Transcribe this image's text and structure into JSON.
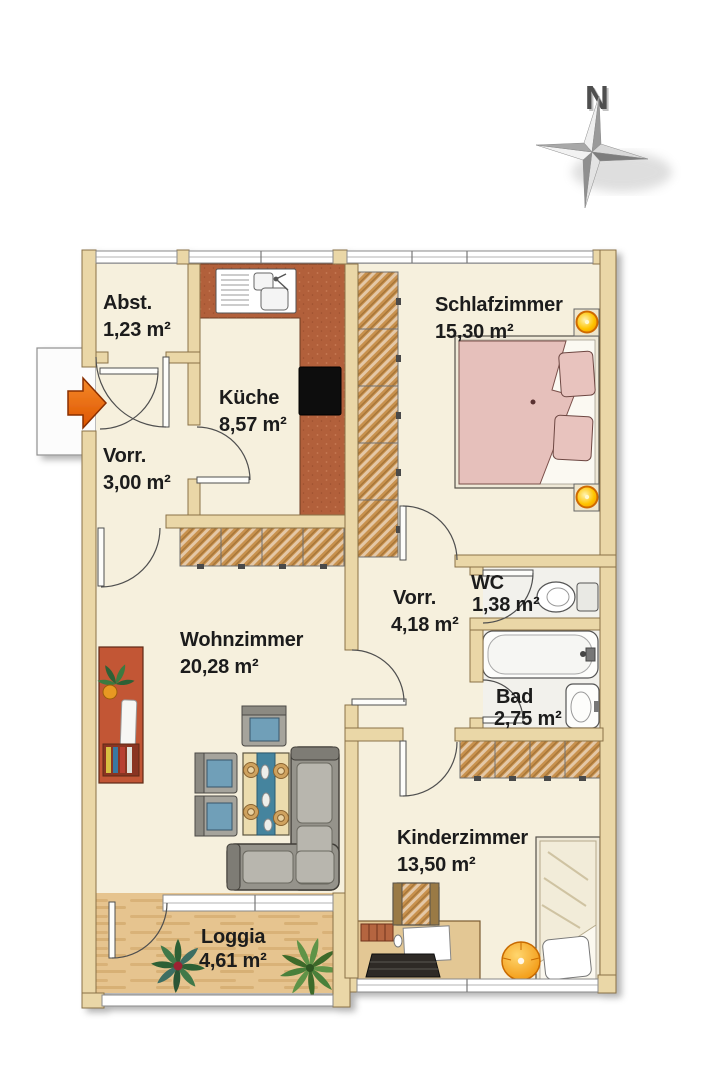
{
  "compass": {
    "north_label": "N"
  },
  "rooms": {
    "abstellraum": {
      "name": "Abst.",
      "area": "1,23 m²"
    },
    "kueche": {
      "name": "Küche",
      "area": "8,57 m²"
    },
    "schlafzimmer": {
      "name": "Schlafzimmer",
      "area": "15,30 m²"
    },
    "vorraum": {
      "name": "Vorr.",
      "area": "3,00 m²"
    },
    "flur": {
      "name": "Vorr.",
      "area": "4,18 m²"
    },
    "wc": {
      "name": "WC",
      "area": "1,38 m²"
    },
    "bad": {
      "name": "Bad",
      "area": "2,75 m²"
    },
    "wohnzimmer": {
      "name": "Wohnzimmer",
      "area": "20,28 m²"
    },
    "kinderzimmer": {
      "name": "Kinderzimmer",
      "area": "13,50 m²"
    },
    "loggia": {
      "name": "Loggia",
      "area": "4,61 m²"
    }
  },
  "colors": {
    "wall": "#ead7a7",
    "wall_stroke": "#8a7246",
    "floor": "#f6f0dd",
    "bath_floor": "#f2f1ec",
    "counter_terracotta": "#b2603a",
    "wardrobe_wood": "#c8914e",
    "loggia_wood": "#e6c48f",
    "bed_pink": "#e6c0bb",
    "sofa_gray": "#95938b",
    "cushion_blue": "#6f9fb8",
    "entrance_orange": "#ee7014",
    "lamp_yellow": "#ffc400"
  }
}
